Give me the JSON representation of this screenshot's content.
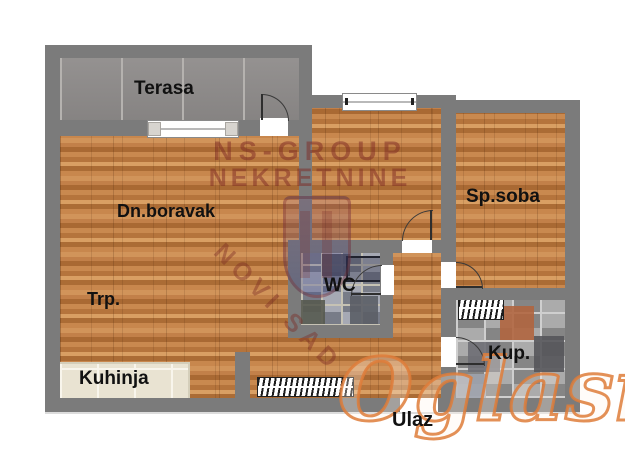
{
  "floorplan": {
    "rooms": {
      "terrace": "Terasa",
      "living_room": "Dn.boravak",
      "dining": "Trp.",
      "kitchen": "Kuhinja",
      "wc": "WC",
      "bedroom": "Sp.soba",
      "bathroom": "Kup.",
      "entrance": "Ulaz"
    },
    "colors": {
      "wall": "#7b7b7b",
      "wood_floor": "#bd7b43",
      "terrace_tile": "#8e8b8a",
      "kitchen_tile": "#e9e3d2",
      "wc_tile": "#9094a0",
      "bath_tile": "#9e9e9e",
      "bath_accent_tile": "#b0653f",
      "label_text": "#111111",
      "watermark_agency": "#7d2a24",
      "watermark_site": "#de7d3a"
    }
  },
  "watermarks": {
    "agency_name": "NS-GROUP",
    "agency_type": "NEKRETNINE",
    "agency_city": "NOVI SAD",
    "site_name": "Oglasi",
    "site_tld": ".rs"
  }
}
